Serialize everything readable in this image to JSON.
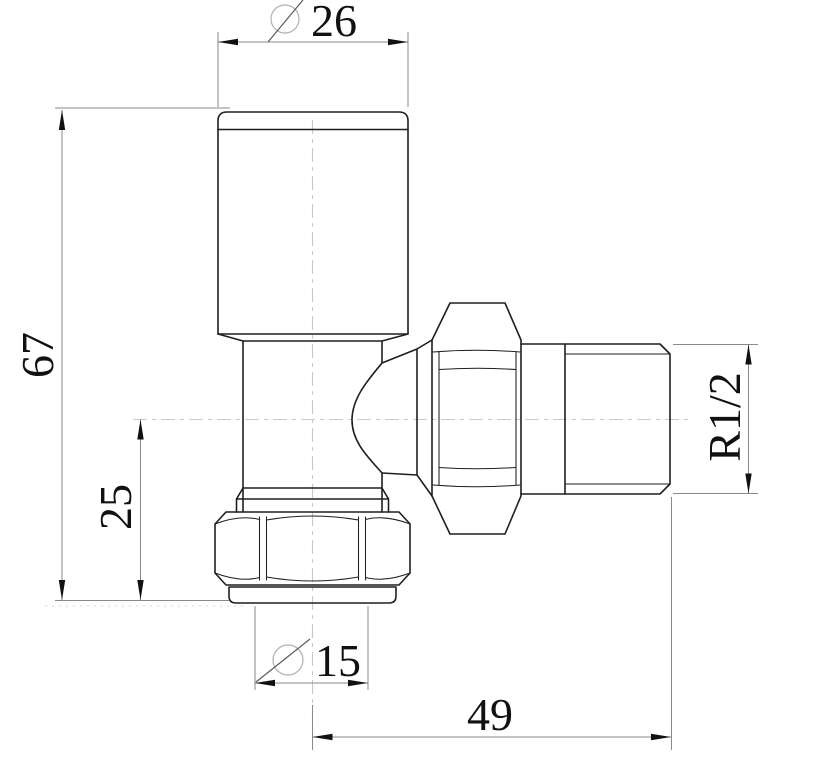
{
  "drawing": {
    "dimensions": {
      "head_diameter": {
        "symbol": "Ø",
        "value": "26"
      },
      "overall_height": {
        "value": "67"
      },
      "axis_to_bottom": {
        "value": "25"
      },
      "pipe_diameter": {
        "symbol": "Ø",
        "value": "15"
      },
      "overall_length": {
        "value": "49"
      },
      "thread_size": {
        "value": "R1/2"
      }
    },
    "colors": {
      "background": "#ffffff",
      "outline": "#1f1f1f",
      "dimension_line": "#8a8a8a",
      "text": "#111111",
      "centerline": "#c9c9c9"
    }
  }
}
